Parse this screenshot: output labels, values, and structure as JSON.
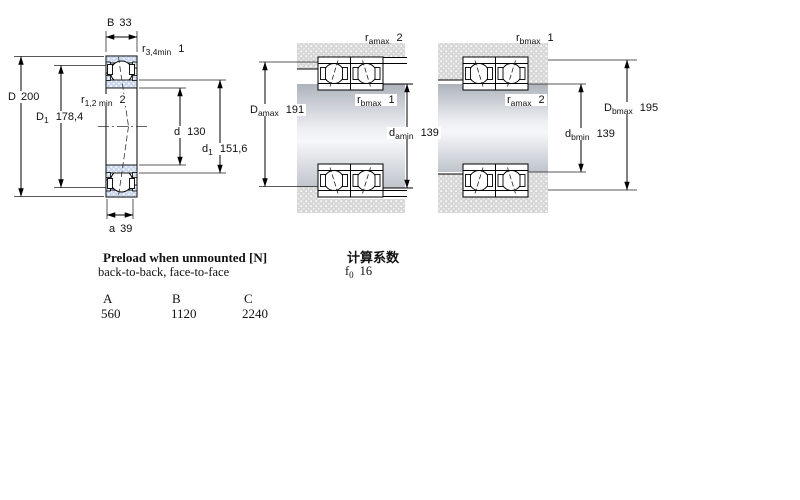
{
  "left_diagram": {
    "width_label": "B",
    "width_value": "33",
    "r34_label": "r",
    "r34_sub": "3,4min",
    "r34_value": "1",
    "outer_dia_label": "D",
    "outer_dia_value": "200",
    "d1_label": "D",
    "d1_sub": "1",
    "d1_value": "178,4",
    "r12_label": "r",
    "r12_sub": "1,2 min",
    "r12_value": "2",
    "bore_label": "d",
    "bore_value": "130",
    "inner_d1_label": "d",
    "inner_d1_sub": "1",
    "inner_d1_value": "151,6",
    "a_label": "a",
    "a_value": "39"
  },
  "middle_diagram": {
    "r_top_label": "r",
    "r_top_sub": "amax",
    "r_top_value": "2",
    "r_mid_label": "r",
    "r_mid_sub": "bmax",
    "r_mid_value": "1",
    "housing_label": "D",
    "housing_sub": "amax",
    "housing_value": "191",
    "shaft_label": "d",
    "shaft_sub": "amin",
    "shaft_value": "139"
  },
  "right_diagram": {
    "r_top_label": "r",
    "r_top_sub": "bmax",
    "r_top_value": "1",
    "r_mid_label": "r",
    "r_mid_sub": "amax",
    "r_mid_value": "2",
    "housing_label": "D",
    "housing_sub": "bmax",
    "housing_value": "195",
    "shaft_label": "d",
    "shaft_sub": "bmin",
    "shaft_value": "139"
  },
  "preload": {
    "title": "Preload when unmounted [N]",
    "subtitle": "back-to-back, face-to-face",
    "columns": [
      "A",
      "B",
      "C"
    ],
    "values": [
      "560",
      "1120",
      "2240"
    ]
  },
  "calculation": {
    "title": "计算系数",
    "f0_label": "f",
    "f0_sub": "0",
    "f0_value": "16"
  },
  "colors": {
    "ring_fill": "#c9d6ee",
    "housing_fill": "#d7d7d7",
    "line": "#000000"
  }
}
